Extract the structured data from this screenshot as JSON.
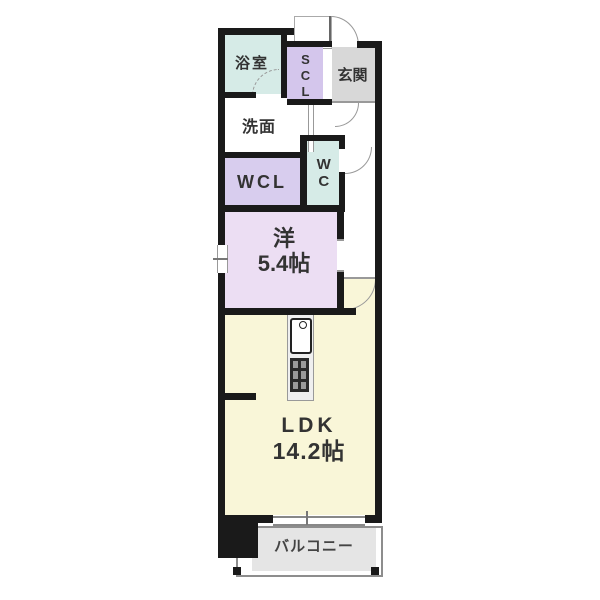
{
  "rooms": {
    "bathroom": {
      "label": "浴室"
    },
    "shoe_closet": {
      "label": "SCL"
    },
    "entrance": {
      "label": "玄関"
    },
    "washroom": {
      "label": "洗面"
    },
    "walk_in_closet": {
      "label": "WCL"
    },
    "toilet": {
      "label": "WC"
    },
    "western_room": {
      "label": "洋",
      "size": "5.4帖"
    },
    "ldk": {
      "label": "LDK",
      "size": "14.2帖"
    },
    "balcony": {
      "label": "バルコニー"
    }
  },
  "icons": {
    "kitchen_sink": "sink-with-faucet",
    "kitchen_stove": "stove-burners",
    "doors": [
      "entrance-swing-door",
      "hall-swing-door",
      "wc-swing-door",
      "ldk-swing-door",
      "bathroom-folding-door-dashed"
    ]
  },
  "colors": {
    "wall": "#1a1a1a",
    "line": "#999999",
    "text": "#333333",
    "aqua": "#d6ebe7",
    "lavender": "#d4c6ec",
    "lavender2": "#d8cdee",
    "pink": "#ecdef3",
    "yellow": "#f9f6d8",
    "genkan": "#d8d8d8",
    "balcony": "#e5e5e5"
  }
}
